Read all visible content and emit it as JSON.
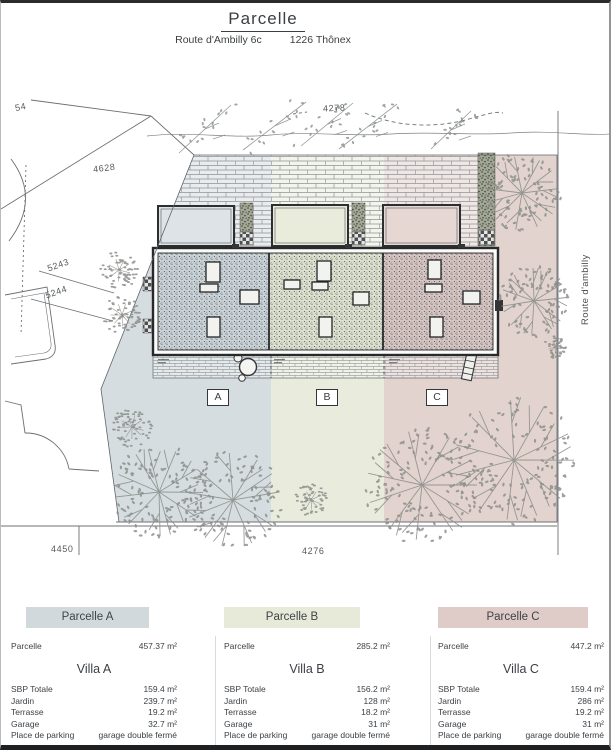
{
  "header": {
    "title": "Parcelle",
    "address": "Route d'Ambilly 6c",
    "city": "1226 Thônex"
  },
  "plan": {
    "road_label": "Route d'ambilly",
    "unit_labels": {
      "a": "A",
      "b": "B",
      "c": "C"
    },
    "dimensions": {
      "top": "4278",
      "driveway": "4628",
      "left_upper": "5243",
      "left_lower": "5244",
      "bottom_left": "4450",
      "bottom_center": "4276",
      "top_left_partial": "54"
    },
    "zone_colors": {
      "a": "#d6dde1",
      "b": "#e9ecdc",
      "c": "#e3d3cf"
    }
  },
  "tables": [
    {
      "id": "A",
      "header": "Parcelle A",
      "header_color": "#d2d9dd",
      "parcel_label": "Parcelle",
      "parcel_area": "457.37 m²",
      "villa_title": "Villa A",
      "rows": [
        {
          "label": "SBP Totale",
          "value": "159.4 m²"
        },
        {
          "label": "Jardin",
          "value": "239.7 m²"
        },
        {
          "label": "Terrasse",
          "value": "19.2 m²"
        },
        {
          "label": "Garage",
          "value": "32.7 m²"
        },
        {
          "label": "Place de parking",
          "value": "garage double fermé"
        }
      ]
    },
    {
      "id": "B",
      "header": "Parcelle B",
      "header_color": "#e7ead9",
      "parcel_label": "Parcelle",
      "parcel_area": "285.2 m²",
      "villa_title": "Villa B",
      "rows": [
        {
          "label": "SBP Totale",
          "value": "156.2 m²"
        },
        {
          "label": "Jardin",
          "value": "128 m²"
        },
        {
          "label": "Terrasse",
          "value": "18.2 m²"
        },
        {
          "label": "Garage",
          "value": "31 m²"
        },
        {
          "label": "Place de parking",
          "value": "garage double fermé"
        }
      ]
    },
    {
      "id": "C",
      "header": "Parcelle C",
      "header_color": "#dfccc8",
      "parcel_label": "Parcelle",
      "parcel_area": "447.2 m²",
      "villa_title": "Villa C",
      "rows": [
        {
          "label": "SBP Totale",
          "value": "159.4 m²"
        },
        {
          "label": "Jardin",
          "value": "286 m²"
        },
        {
          "label": "Terrasse",
          "value": "19.2 m²"
        },
        {
          "label": "Garage",
          "value": "31 m²"
        },
        {
          "label": "Place de parking",
          "value": "garage double fermé"
        }
      ]
    }
  ]
}
